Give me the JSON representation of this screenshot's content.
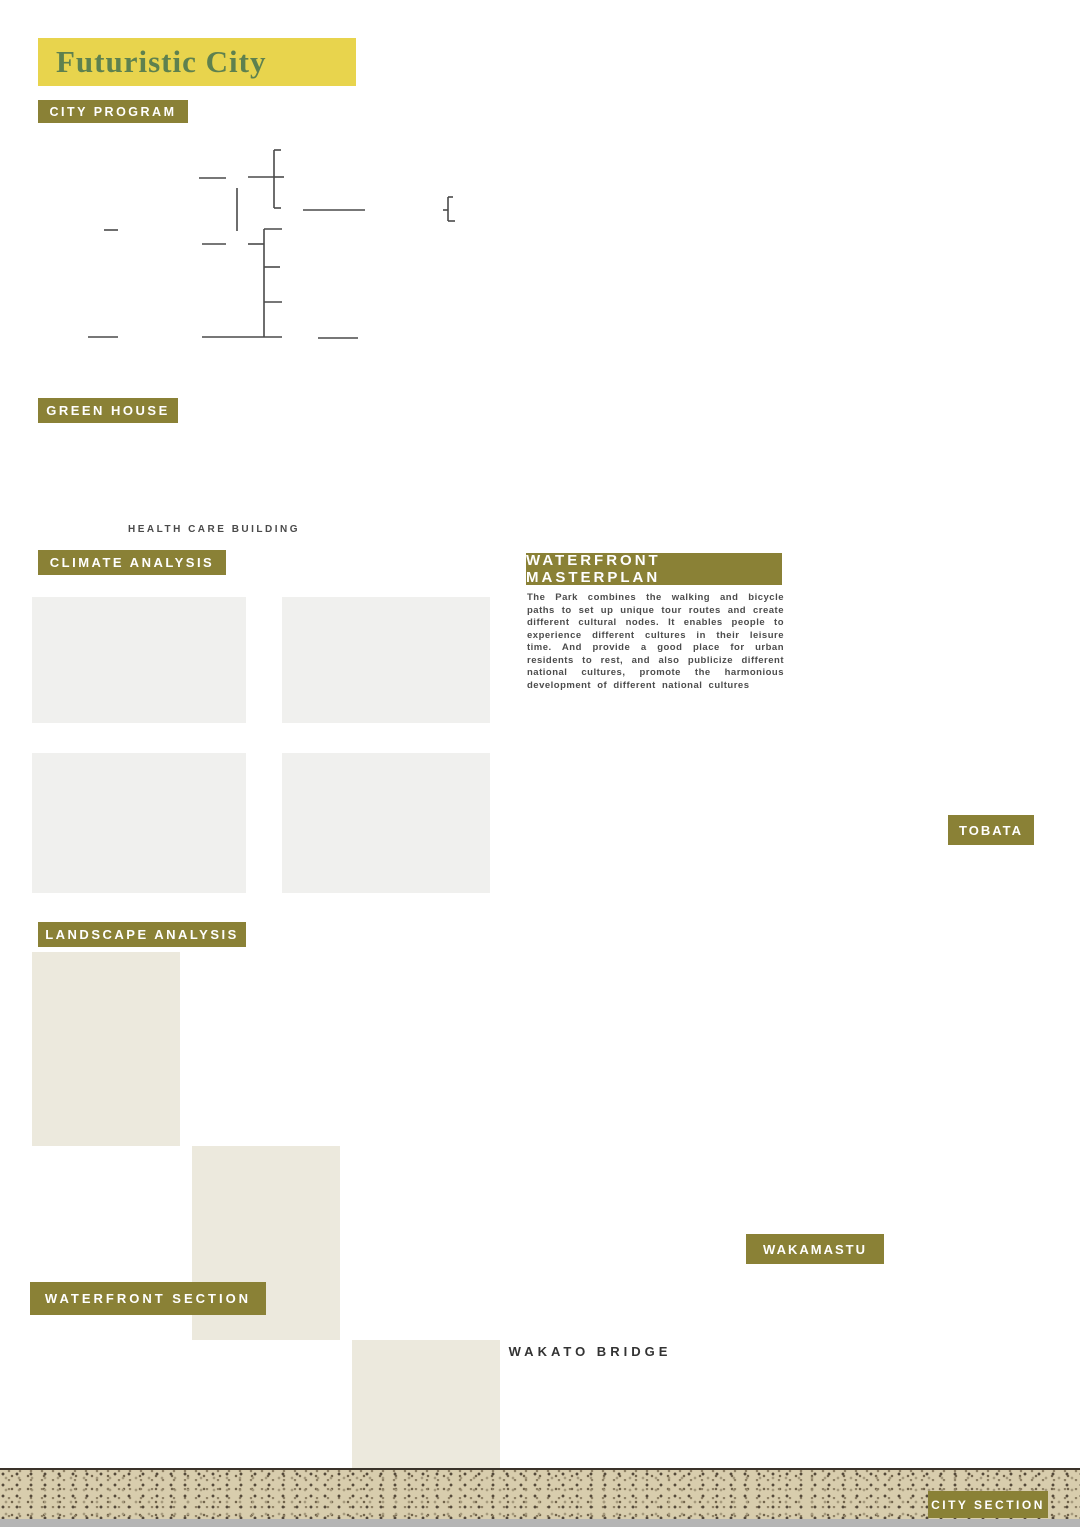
{
  "title": "Futuristic City",
  "palette": {
    "olive": "#8a8136",
    "banner_yellow": "#e8d44d",
    "bar_yellow": "#ead44e",
    "bridge_red": "#b5443a",
    "map_green": "#7f8c42",
    "dash_yellow": "#e9c33c",
    "dotted_red": "#d8472b"
  },
  "city_program": {
    "header": "CITY PROGRAM",
    "nodes": [
      {
        "id": "travelling",
        "label": "TRAVELLING",
        "icon": "pin"
      },
      {
        "id": "homestay",
        "label": "HOMESTAY",
        "icon": "house",
        "boxed": true
      },
      {
        "id": "renting",
        "label": "RENTING BICYCLE FACILITIES",
        "icon": "bikeshed",
        "boxed": true
      },
      {
        "id": "good_view",
        "label": "GOOD VIEW",
        "icon": "glasses"
      },
      {
        "id": "water_fronts",
        "label": "WATER FRONTS",
        "icon": "steps",
        "boxed": true
      },
      {
        "id": "electricity_tank",
        "label": "ELECTRICITY TANK",
        "icon": "trash"
      },
      {
        "id": "water_tank",
        "label": "WATER TANK",
        "icon": "tank"
      },
      {
        "id": "energy_production",
        "label": "ENERGY PRODUCTION",
        "icon": "bolt"
      },
      {
        "id": "light",
        "label": "LIGHT",
        "icon": "bulb"
      },
      {
        "id": "saving_money",
        "label": "SAVING MONEY",
        "icon": "coins"
      },
      {
        "id": "fresh_water",
        "label": "FRESH WATER",
        "icon": "water"
      },
      {
        "id": "toilet",
        "label": "TOILET",
        "icon": "toilet"
      },
      {
        "id": "taking_shower",
        "label": "TAKING SHOWER",
        "icon": "shower"
      },
      {
        "id": "watering_trees",
        "label": "WATERING TREES",
        "icon": "trees"
      },
      {
        "id": "green_corridor",
        "label": "GREEN CORRIDOR",
        "icon": "trees3"
      },
      {
        "id": "health_care_system",
        "label": "HEALTH CARE SYSTEM",
        "icon": "cross",
        "boxed": true
      },
      {
        "id": "treatment",
        "label": "TREATMENT",
        "icon": "bed"
      },
      {
        "id": "happiness",
        "label": "HAPPINESS",
        "icon": "heart"
      }
    ]
  },
  "green_house": {
    "header": "GREEN HOUSE",
    "caption": "HEALTH CARE BUILDING"
  },
  "climate": {
    "header": "CLIMATE ANALYSIS"
  },
  "chart_data": [
    {
      "id": "sky_cover",
      "type": "range_bar",
      "title": "SKY COVER RANGE",
      "categories": [
        "JAN",
        "FEB",
        "MAR",
        "APR",
        "MAY",
        "JUN",
        "JUL",
        "AUG",
        "SEP",
        "OCT",
        "NOV",
        "DEC"
      ],
      "annual_label": "ANNUAL",
      "low": [
        25,
        32,
        48,
        45,
        35,
        48,
        42,
        30,
        32,
        20,
        22,
        25
      ],
      "high": [
        75,
        78,
        92,
        88,
        85,
        96,
        90,
        92,
        88,
        68,
        76,
        80
      ],
      "median": [
        48,
        55,
        72,
        65,
        58,
        70,
        62,
        60,
        58,
        45,
        52,
        57
      ],
      "annual": {
        "low": 25,
        "high": 78,
        "median": 55
      },
      "ylim": [
        0,
        100
      ],
      "grid_step": 10,
      "unit": "%"
    },
    {
      "id": "wind_velocity",
      "type": "range_bar",
      "title": "WIND VELOCITY RANGE",
      "categories": [
        "JAN",
        "FEB",
        "MAR",
        "APR",
        "MAY",
        "JUN",
        "JUL",
        "AUG",
        "SEP",
        "OCT",
        "NOV",
        "DEC"
      ],
      "annual_label": "ANNUAL",
      "low": [
        2,
        3,
        3,
        2,
        1,
        2,
        1,
        2,
        2,
        1,
        2,
        1
      ],
      "high": [
        12,
        16,
        22,
        15,
        13,
        16,
        14,
        15,
        14,
        12,
        18,
        13
      ],
      "median": [
        6,
        8,
        10,
        7,
        6,
        8,
        6,
        7,
        7,
        5,
        9,
        6
      ],
      "annual": {
        "low": 2,
        "high": 15,
        "median": 7
      },
      "ylim": [
        0,
        90
      ],
      "grid_step": 10,
      "unit": "km/h"
    },
    {
      "id": "temperature",
      "type": "range_bar",
      "title": "TEMPERATURE RANGE",
      "categories": [
        "JAN",
        "FEB",
        "MAR",
        "APR",
        "MAY",
        "JUN",
        "JUL",
        "AUG",
        "SEP",
        "OCT",
        "NOV",
        "DEC"
      ],
      "annual_label": "ANNUAL",
      "low": [
        0,
        1,
        4,
        9,
        14,
        18,
        23,
        24,
        20,
        13,
        7,
        2
      ],
      "high": [
        11,
        13,
        16,
        21,
        25,
        27,
        31,
        33,
        29,
        23,
        17,
        12
      ],
      "median": [
        5,
        7,
        10,
        15,
        19,
        23,
        27,
        28,
        24,
        18,
        12,
        7
      ],
      "annual": {
        "low": 1,
        "high": 31,
        "median": 16
      },
      "ylim": [
        -10,
        40
      ],
      "grid_step": 5,
      "comfort_band": [
        18,
        23
      ],
      "unit": "°C"
    },
    {
      "id": "wind_wheel",
      "type": "polar",
      "title": "WIND WHEEL",
      "directions": 36,
      "calm_spokes": [
        0.5,
        0.85,
        0.9,
        0.95,
        0.92,
        0.9,
        0.95,
        0.92,
        0.88,
        0.9,
        0.93,
        0.9,
        0.88,
        0.92,
        0.95,
        0.9,
        0.85,
        0.8,
        0.85,
        0.9,
        0.92,
        0.95,
        0.9,
        0.88,
        0.92,
        0.9,
        0.93,
        0.95,
        0.9,
        0.92,
        0.88,
        0.9,
        0.93,
        0.9,
        0.85,
        0.7
      ],
      "outer_bars": [
        0.55,
        0.5,
        0.42,
        0.32,
        0.25,
        0.2,
        0.18,
        0.15,
        0.12,
        0.18,
        0.14,
        0.1,
        0.15,
        0.22,
        0.28,
        0.32,
        0.38,
        0.32,
        0.36,
        0.42,
        0.36,
        0.3,
        0.4,
        0.46,
        0.52,
        0.58,
        0.65,
        0.75,
        0.85,
        0.9,
        0.88,
        0.82,
        0.78,
        0.72,
        0.66,
        0.58
      ],
      "rings": {
        "inner_spokes": "#e07b28",
        "ring1": "#8a8136",
        "ring2": "#7cd23d",
        "ring3": "#cfcfcf",
        "arc_top": "#9aa0d8",
        "outer": "#d9a728"
      }
    }
  ],
  "landscape": {
    "header": "LANDSCAPE ANALYSIS",
    "maps": [
      {
        "caption": "FUNCTION",
        "legend": [
          {
            "label": "RESIDENT",
            "symbol": "dash-circle",
            "color": "#e9c33c"
          },
          {
            "label": "GREEN CORRIDOR",
            "symbol": "dash-circle",
            "color": "#7ec4e8"
          }
        ]
      },
      {
        "caption": "AXIS",
        "legend": [
          {
            "label": "AXIS",
            "symbol": "dash-circle",
            "color": "#e9c33c"
          }
        ]
      },
      {
        "caption": "STREAMLINE",
        "legend": [
          {
            "label": "PORT",
            "symbol": "dot",
            "color": "#a83434"
          },
          {
            "label": "WALK",
            "symbol": "dash-circle",
            "color": "#e9c33c"
          },
          {
            "label": "BOAT",
            "symbol": "dash-circle",
            "color": "#7ec4e8"
          }
        ]
      }
    ]
  },
  "waterfront_section": {
    "header": "WATERFRONT SECTION"
  },
  "masterplan": {
    "header": "WATERFRONT MASTERPLAN",
    "paragraph": "The Park combines the walking and bicycle paths to set up unique tour routes and create different cultural nodes. It enables people to experience different cultures in their leisure time. And provide a good place for urban residents to rest, and also publicize different national cultures, promote the harmonious development of different national cultures",
    "labels": {
      "tobata": "TOBATA",
      "wakamastu": "WAKAMASTU"
    }
  },
  "city_section": {
    "bridge_label": "WAKATO BRIDGE",
    "header": "CITY SECTION",
    "icons": [
      {
        "id": "citizen_l",
        "label": "CITIZEN",
        "icon": "people",
        "color": "#ddd24e",
        "text": "#77762c"
      },
      {
        "id": "green_corridor_l",
        "label": "GREEN CORRIDOR",
        "icon": "plant",
        "color": "#ddd24e",
        "text": "#ffffff"
      },
      {
        "id": "bicycle_l",
        "label": "BICYCLE SHARING",
        "icon": "bicycle",
        "color": "#c3c64c",
        "text": "#ffffff"
      },
      {
        "id": "health_l",
        "label": "HEALTH CARE",
        "icon": "firstaid",
        "color": "#74894a",
        "text": "#ffffff"
      },
      {
        "id": "homestay_l",
        "label": "HOMESTAY",
        "icon": "pagoda",
        "color": "#57644f",
        "text": "#e8d44d"
      },
      {
        "id": "waterfront_l",
        "label": "WATER FRONT",
        "icon": "drop",
        "color": "#ddd24e",
        "text": "#ffffff"
      },
      {
        "id": "waterfront_r",
        "label": "WATER FRONT",
        "icon": "drop",
        "color": "#ddd24e",
        "text": "#ffffff"
      },
      {
        "id": "bicycle_r",
        "label": "BICYCLE SHARING",
        "icon": "bicycle",
        "color": "#c3c64c",
        "text": "#ffffff"
      },
      {
        "id": "health_r",
        "label": "HEALTH CARE",
        "icon": "firstaid",
        "color": "#74894a",
        "text": "#ffffff"
      },
      {
        "id": "homestay_r",
        "label": "HOMESTAY",
        "icon": "pagoda",
        "color": "#57644f",
        "text": "#e8d44d"
      },
      {
        "id": "green_corridor_r",
        "label": "GREEN CORRIDOR",
        "icon": "plant",
        "color": "#ddd24e",
        "text": "#ffffff"
      },
      {
        "id": "citizen_r",
        "label": "CITIZEN",
        "icon": "people",
        "color": "#ddd24e",
        "text": "#77762c"
      }
    ]
  }
}
